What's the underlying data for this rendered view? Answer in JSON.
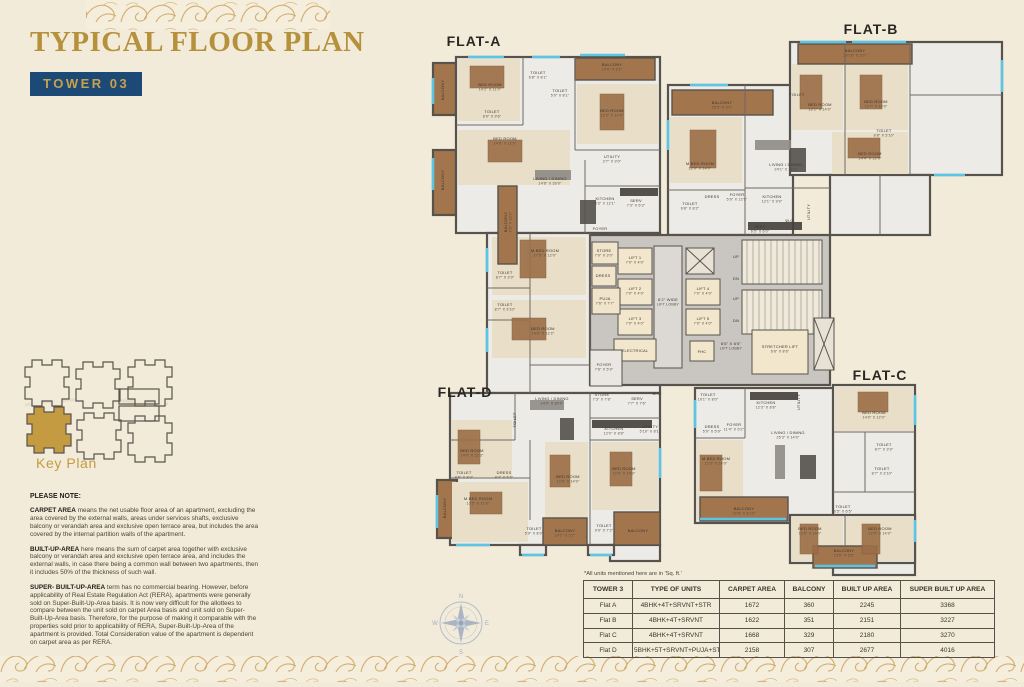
{
  "page": {
    "title": "TYPICAL FLOOR PLAN",
    "tower_badge": "TOWER 03"
  },
  "key_plan": {
    "label": "Key Plan"
  },
  "compass": {
    "n": "N",
    "e": "E",
    "s": "S",
    "w": "W"
  },
  "notes": {
    "heading": "PLEASE NOTE:",
    "paragraphs": [
      {
        "lead": "CARPET AREA",
        "text": " means the net usable floor area of an apartment, excluding the area covered by the external walls, areas under services shafts, exclusive balcony or verandah area and exclusive open terrace area, but includes the area covered by the internal partition walls of the apartment."
      },
      {
        "lead": "BUILT-UP-AREA",
        "text": " here means the sum of carpet area together with exclusive balcony or verandah area and exclusive open terrace area, and includes the external walls, in case there being a common wall between two apartments, then it includes 50% of the thickness of such wall."
      },
      {
        "lead": "SUPER- BUILT-UP-AREA",
        "text": " term has no commercial bearing. However, before applicability of Real Estate Regulation Act (RERA), apartments were generally sold on Super-Built-Up-Area basis. It is now very difficult for the allottees to compare between the unit sold on carpet Area basis and unit sold on Super-Built-Up-Area basis. Therefore, for the purpose of making it comparable with the properties sold prior to applicability of RERA, Super-Built-Up-Area of the apartment is provided. Total Consideration value of the apartment is dependent on carpet area as per RERA."
      }
    ]
  },
  "table": {
    "note": "*All units mentioned here are in 'Sq. ft.'",
    "headers": [
      "TOWER 3",
      "TYPE OF UNITS",
      "CARPET AREA",
      "BALCONY",
      "BUILT UP AREA",
      "SUPER BUILT UP AREA"
    ],
    "rows": [
      [
        "Flat A",
        "4BHK+4T+SRVNT+STR",
        "1672",
        "360",
        "2245",
        "3368"
      ],
      [
        "Flat B",
        "4BHK+4T+SRVNT",
        "1622",
        "351",
        "2151",
        "3227"
      ],
      [
        "Flat C",
        "4BHK+4T+SRVNT",
        "1668",
        "329",
        "2180",
        "3270"
      ],
      [
        "Flat D",
        "5BHK+5T+SRVNT+PUJA+STR",
        "2158",
        "307",
        "2677",
        "4016"
      ]
    ]
  },
  "colors": {
    "page_bg": "#f2ebd9",
    "accent_gold": "#b6913b",
    "badge_bg": "#1c4975",
    "wall": "#57524c",
    "window": "#5cc5e4",
    "balcony_wood": "#a3754d",
    "key_plan_highlight": "#c49b40"
  },
  "plan": {
    "flats": [
      {
        "label": "FLAT-A",
        "x": 474,
        "y": 46
      },
      {
        "label": "FLAT-B",
        "x": 871,
        "y": 34
      },
      {
        "label": "FLAT-C",
        "x": 880,
        "y": 380
      },
      {
        "label": "FLAT-D",
        "x": 465,
        "y": 397
      }
    ],
    "rooms": [
      {
        "t": "BED ROOM",
        "d": "14'2\" X 11'0\"",
        "x": 490,
        "y": 86
      },
      {
        "t": "TOILET",
        "d": "6'8\" X 8'1\"",
        "x": 538,
        "y": 74
      },
      {
        "t": "TOILET",
        "d": "5'9\" X 8'1\"",
        "x": 560,
        "y": 92
      },
      {
        "t": "BALCONY",
        "d": "14'0\" X 5'2\"",
        "x": 612,
        "y": 66
      },
      {
        "t": "BED ROOM",
        "d": "12'2\" X 14'0\"",
        "x": 612,
        "y": 112
      },
      {
        "t": "TOILET",
        "d": "8'0\" X 9'6\"",
        "x": 492,
        "y": 113
      },
      {
        "t": "BED ROOM",
        "d": "14'8\" X 12'0\"",
        "x": 505,
        "y": 140
      },
      {
        "t": "UTILITY",
        "d": "2'7\" X 9'0\"",
        "x": 612,
        "y": 158
      },
      {
        "t": "LIVING / DINING",
        "d": "14'6\" X 26'0\"",
        "x": 550,
        "y": 180
      },
      {
        "t": "KITCHEN",
        "d": "8'3\" X 12'1\"",
        "x": 605,
        "y": 200
      },
      {
        "t": "SERV",
        "d": "7'3\" X 6'3\"",
        "x": 636,
        "y": 202
      },
      {
        "t": "FOYER",
        "d": "7'5\" X 5'9\"",
        "x": 600,
        "y": 230
      },
      {
        "t": "BALCONY",
        "d": "6'3\" X 12'2\"",
        "x": 507,
        "y": 222,
        "v": 1
      },
      {
        "t": "M.BED ROOM",
        "d": "17'5\" X 12'0\"",
        "x": 545,
        "y": 252
      },
      {
        "t": "TOILET",
        "d": "8'7\" X 3'9\"",
        "x": 505,
        "y": 274
      },
      {
        "t": "TOILET",
        "d": "8'7\" X 3'10\"",
        "x": 505,
        "y": 306
      },
      {
        "t": "BED ROOM",
        "d": "14'6\" X 12'2\"",
        "x": 543,
        "y": 330
      },
      {
        "t": "BALCONY",
        "x": 444,
        "y": 90,
        "v": 1
      },
      {
        "t": "BALCONY",
        "x": 444,
        "y": 180,
        "v": 1
      },
      {
        "t": "STORE",
        "d": "7'0\" X 3'0\"",
        "x": 604,
        "y": 252
      },
      {
        "t": "DRESS",
        "x": 603,
        "y": 277
      },
      {
        "t": "PUJA",
        "d": "7'6\" X 7'7\"",
        "x": 605,
        "y": 300
      },
      {
        "t": "LIFT 1",
        "d": "7'0\" X 4'0\"",
        "x": 635,
        "y": 259
      },
      {
        "t": "LIFT 2",
        "d": "7'0\" X 4'0\"",
        "x": 635,
        "y": 290
      },
      {
        "t": "LIFT 3",
        "d": "7'0\" X 4'0\"",
        "x": 635,
        "y": 320
      },
      {
        "t": "ELECTRICAL",
        "x": 635,
        "y": 352
      },
      {
        "t": "6'2\" WIDE",
        "d": "LIFT LOBBY",
        "x": 668,
        "y": 301
      },
      {
        "t": "LIFT 4",
        "d": "7'0\" X 4'0\"",
        "x": 703,
        "y": 290
      },
      {
        "t": "LIFT 5",
        "d": "7'0\" X 4'0\"",
        "x": 703,
        "y": 320
      },
      {
        "t": "FHC",
        "x": 702,
        "y": 353
      },
      {
        "t": "UP",
        "x": 736,
        "y": 258
      },
      {
        "t": "DN",
        "x": 736,
        "y": 280
      },
      {
        "t": "UP",
        "x": 736,
        "y": 300
      },
      {
        "t": "DN",
        "x": 736,
        "y": 322
      },
      {
        "t": "6'6\" X 6'6\"",
        "d": "LIFT LOBBY",
        "x": 731,
        "y": 345
      },
      {
        "t": "STRETCHER LIFT",
        "d": "6'6\" X 8'6\"",
        "x": 780,
        "y": 348
      },
      {
        "t": "FOYER",
        "d": "7'8\" X 5'9\"",
        "x": 604,
        "y": 366
      },
      {
        "t": "BALCONY",
        "d": "25'5\" X 5'0\"",
        "x": 722,
        "y": 104
      },
      {
        "t": "M.BED ROOM",
        "d": "12'0\" X 14'0\"",
        "x": 700,
        "y": 165
      },
      {
        "t": "LIVING / DINING",
        "d": "24'1\" X 14'0\"",
        "x": 786,
        "y": 166
      },
      {
        "t": "TOILET",
        "d": "6'8\" X 8'2\"",
        "x": 690,
        "y": 205
      },
      {
        "t": "DRESS",
        "x": 712,
        "y": 198
      },
      {
        "t": "FOYER",
        "d": "5'9\" X 12'9\"",
        "x": 737,
        "y": 196
      },
      {
        "t": "KITCHEN",
        "d": "12'1\" X 9'9\"",
        "x": 772,
        "y": 198
      },
      {
        "t": "SERV",
        "d": "6'5\" X 6'0\"",
        "x": 760,
        "y": 228
      },
      {
        "t": "W.C.",
        "x": 790,
        "y": 222
      },
      {
        "t": "UTILITY",
        "x": 810,
        "y": 212,
        "v": 1
      },
      {
        "t": "BALCONY",
        "d": "20'10\" X 5'2\"",
        "x": 855,
        "y": 52
      },
      {
        "t": "TOILET",
        "x": 797,
        "y": 96
      },
      {
        "t": "BED ROOM",
        "d": "12'1\" X 14'0\"",
        "x": 820,
        "y": 106
      },
      {
        "t": "BED ROOM",
        "d": "12'7\" X 14'0\"",
        "x": 876,
        "y": 103
      },
      {
        "t": "TOILET",
        "d": "8'8\" X 5'10\"",
        "x": 884,
        "y": 132
      },
      {
        "t": "BED ROOM",
        "d": "14'4\" X 12'0\"",
        "x": 870,
        "y": 155
      },
      {
        "t": "LIVING / DINING",
        "d": "14'9\" X 30'9\"",
        "x": 552,
        "y": 400
      },
      {
        "t": "STORE",
        "d": "7'3\" X 7'8\"",
        "x": 602,
        "y": 396
      },
      {
        "t": "SERV",
        "d": "7'7\" X 7'6\"",
        "x": 637,
        "y": 400
      },
      {
        "t": "W.C.",
        "x": 657,
        "y": 395
      },
      {
        "t": "KITCHEN",
        "d": "12'0\" X 8'8\"",
        "x": 614,
        "y": 430
      },
      {
        "t": "UTILITY",
        "d": "5'10\" X 8'1\"",
        "x": 650,
        "y": 428
      },
      {
        "t": "TOILET",
        "x": 516,
        "y": 420,
        "v": 1
      },
      {
        "t": "BED ROOM",
        "d": "14'0\" X 12'3\"",
        "x": 472,
        "y": 452
      },
      {
        "t": "TOILET",
        "d": "9'9\" X 8'0\"",
        "x": 464,
        "y": 474
      },
      {
        "t": "DRESS",
        "d": "9'4\" X 5'3\"",
        "x": 504,
        "y": 474
      },
      {
        "t": "M.BED ROOM",
        "d": "13'5\" X 12'0\"",
        "x": 478,
        "y": 500
      },
      {
        "t": "BALCONY",
        "x": 446,
        "y": 508,
        "v": 1
      },
      {
        "t": "BED ROOM",
        "d": "12'0\" X 14'0\"",
        "x": 568,
        "y": 478
      },
      {
        "t": "TOILET",
        "d": "5'9\" X 8'0\"",
        "x": 534,
        "y": 530
      },
      {
        "t": "BALCONY",
        "d": "10'1\" X 5'2\"",
        "x": 565,
        "y": 532
      },
      {
        "t": "TOILET",
        "d": "9'9\" X 7'2\"",
        "x": 604,
        "y": 527
      },
      {
        "t": "BED ROOM",
        "d": "12'0\" X 14'0\"",
        "x": 624,
        "y": 470
      },
      {
        "t": "BALCONY",
        "x": 638,
        "y": 532
      },
      {
        "t": "TOILET",
        "d": "10'1\" X 8'0\"",
        "x": 708,
        "y": 396
      },
      {
        "t": "KITCHEN",
        "d": "12'3\" X 8'8\"",
        "x": 766,
        "y": 404
      },
      {
        "t": "UTILITY",
        "x": 800,
        "y": 402,
        "v": 1
      },
      {
        "t": "DRESS",
        "d": "5'9\" X 5'9\"",
        "x": 712,
        "y": 428
      },
      {
        "t": "FOYER",
        "d": "11'4\" X 5'2\"",
        "x": 734,
        "y": 426
      },
      {
        "t": "LIVING / DINING",
        "d": "25'3\" X 14'0\"",
        "x": 788,
        "y": 434
      },
      {
        "t": "M.BED ROOM",
        "d": "12'3\" X 14'0\"",
        "x": 716,
        "y": 460
      },
      {
        "t": "BALCONY",
        "d": "22'8\" X 5'10\"",
        "x": 744,
        "y": 510
      },
      {
        "t": "BED ROOM",
        "d": "14'0\" X 12'0\"",
        "x": 874,
        "y": 414
      },
      {
        "t": "TOILET",
        "d": "8'7\" X 3'9\"",
        "x": 884,
        "y": 446
      },
      {
        "t": "TOILET",
        "d": "8'7\" X 3'10\"",
        "x": 882,
        "y": 470
      },
      {
        "t": "TOILET",
        "d": "6'5\" X 6'5\"",
        "x": 843,
        "y": 508
      },
      {
        "t": "BED ROOM",
        "d": "12'0\" X 14'0\"",
        "x": 810,
        "y": 530
      },
      {
        "t": "BED ROOM",
        "d": "12'0\" X 14'0\"",
        "x": 880,
        "y": 530
      },
      {
        "t": "BALCONY",
        "d": "13'5\" X 5'5\"",
        "x": 844,
        "y": 552
      }
    ]
  }
}
